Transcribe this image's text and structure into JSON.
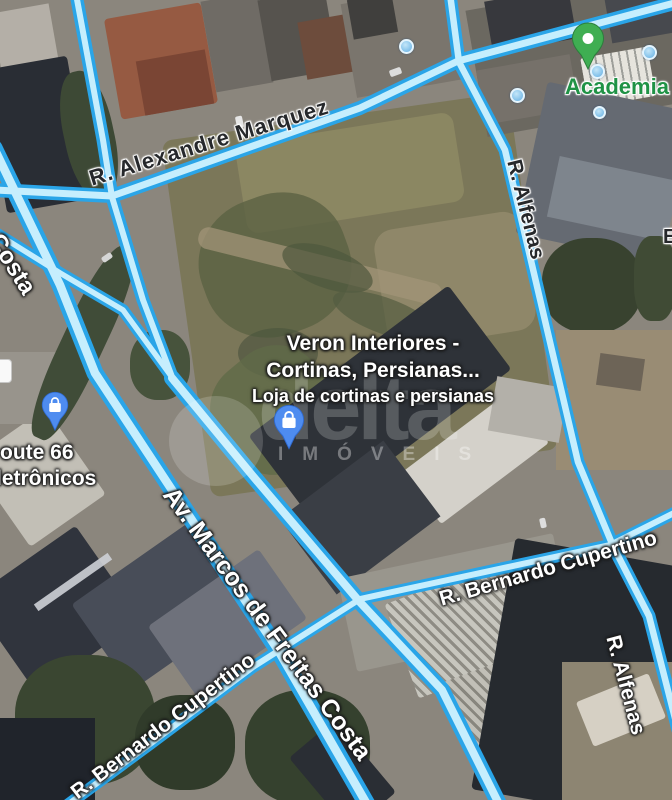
{
  "labels": {
    "alexandre_marquez": "R. Alexandre Marquez",
    "alfenas_top": "R. Alfenas",
    "costa": "Costa",
    "av_marcos": "Av. Marcos de Freitas Costa",
    "cupertino_left": "R. Bernardo Cupertino",
    "cupertino_right": "R. Bernardo Cupertino",
    "alfenas_bottom": "R. Alfenas",
    "edge_partial": "E"
  },
  "pois": {
    "academia": {
      "label": "Academia",
      "icon": "green-place-pin"
    },
    "veron": {
      "title_line1": "Veron Interiores -",
      "title_line2": "Cortinas, Persianas...",
      "subtitle": "Loja de cortinas e persianas",
      "icon": "blue-shopping-pin"
    },
    "route66": {
      "line1": "oute 66",
      "line2": "letrônicos",
      "icon": "blue-shopping-pin"
    }
  },
  "watermark": {
    "brand": "delta",
    "subtitle": "IMÓVEIS"
  },
  "icons": [
    "green-place-pin",
    "blue-shopping-pin",
    "poi-dot",
    "partial-poi-card"
  ],
  "colors": {
    "road_fill": "#c6eefd",
    "road_border": "#2aa5e8",
    "pin_green": "#3fae52",
    "pin_blue": "#4e8cf0",
    "label_green": "#1f9245",
    "lot_olive": "#7b7757"
  }
}
